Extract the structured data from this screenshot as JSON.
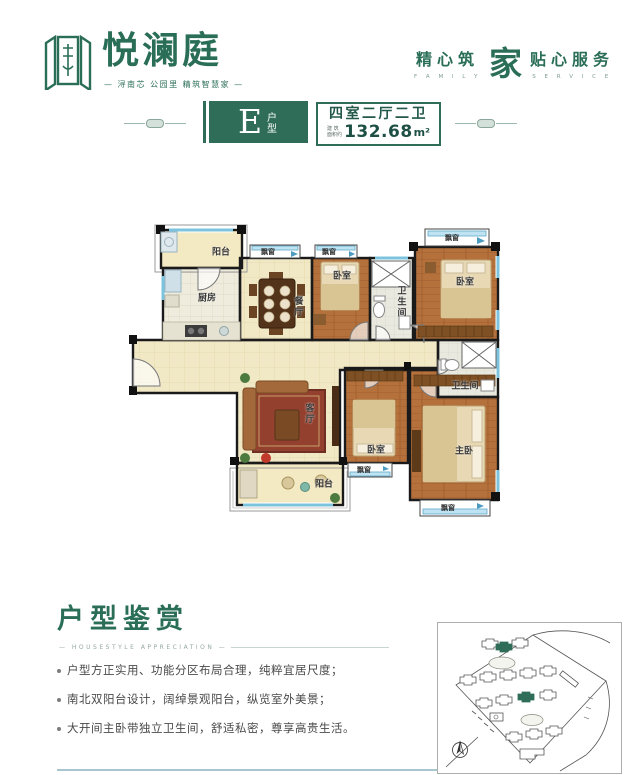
{
  "brand": {
    "name": "悦澜庭",
    "tagline": "— 浔南芯 公园里 精筑智慧家 —",
    "service": {
      "left": "精心筑",
      "left_en": "F A M I L Y",
      "logo_char": "家",
      "right": "贴心服务",
      "right_en": "S E R V I C E"
    }
  },
  "unit_header": {
    "type_letter": "E",
    "type_label": "户型",
    "rooms_label": "四室二厅二卫",
    "area_prefix_top": "建 筑",
    "area_prefix_bottom": "面积约",
    "area_value": "132.68",
    "area_unit": "m²"
  },
  "floorplan": {
    "labels": {
      "balcony": "阳台",
      "kitchen": "厨房",
      "dining": "餐厅",
      "bedroom": "卧室",
      "bathroom": "卫生间",
      "living": "客厅",
      "master_bedroom": "主卧",
      "bay_window": "飘窗"
    }
  },
  "appreciation": {
    "title": "户型鉴赏",
    "subtitle": "—  HOUSESTYLE  APPRECIATION  —",
    "bullets": [
      "户型方正实用、功能分区布局合理，纯粹宜居尺度；",
      "南北双阳台设计，阔绰景观阳台，纵览室外美景；",
      "大开间主卧带独立卫生间，舒适私密，尊享高贵生活。"
    ]
  },
  "colors": {
    "brand_green": "#2a6e57",
    "badge_green": "#2f6d58",
    "window_blue": "#7cc4de",
    "wall_black": "#1a1a1a",
    "floor_cream": "#f1e8c6",
    "floor_wood": "#b5713c"
  }
}
